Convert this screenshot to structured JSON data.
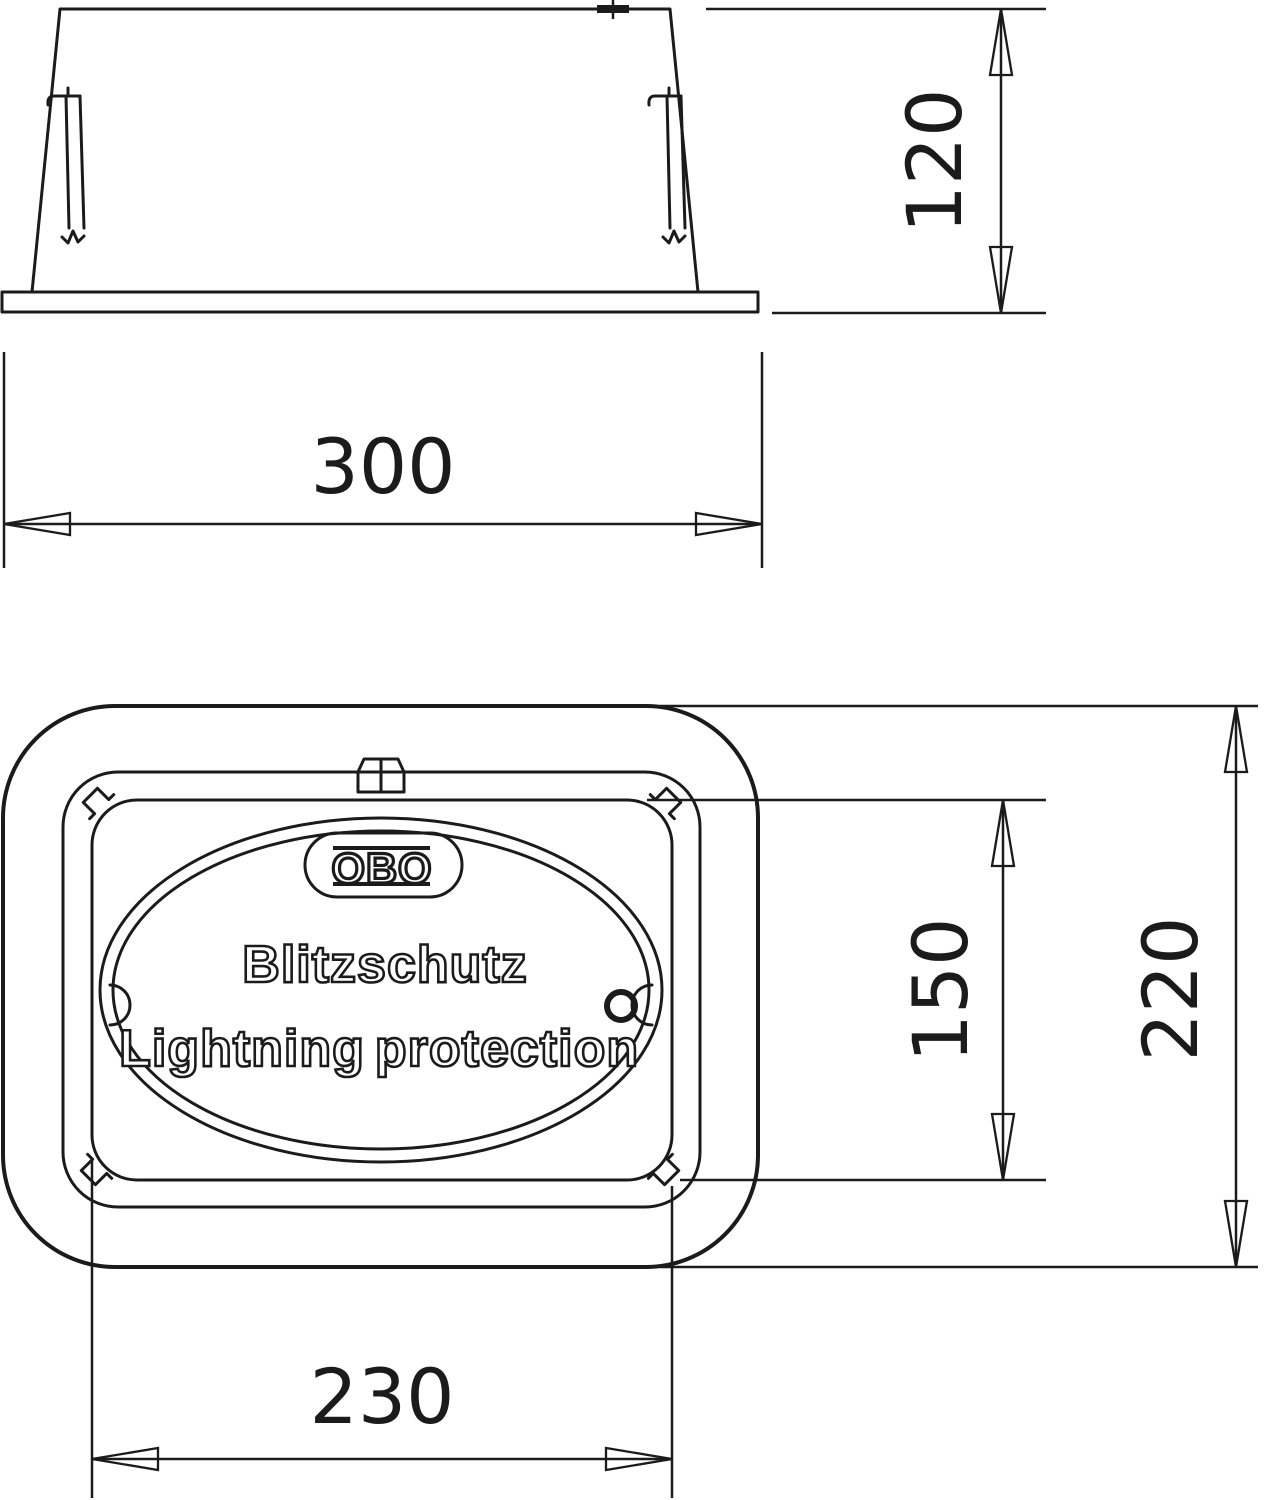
{
  "side_view": {
    "dim_height": "120",
    "dim_width": "300"
  },
  "plan_view": {
    "dim_lid_height": "150",
    "dim_plate_height": "220",
    "dim_lid_width": "230",
    "label": {
      "brand": "OBO",
      "line1": "Blitzschutz",
      "line2a": "Lightning",
      "line2b": "protection"
    }
  },
  "colors": {
    "line": "#1b1b1b",
    "background": "#ffffff"
  }
}
